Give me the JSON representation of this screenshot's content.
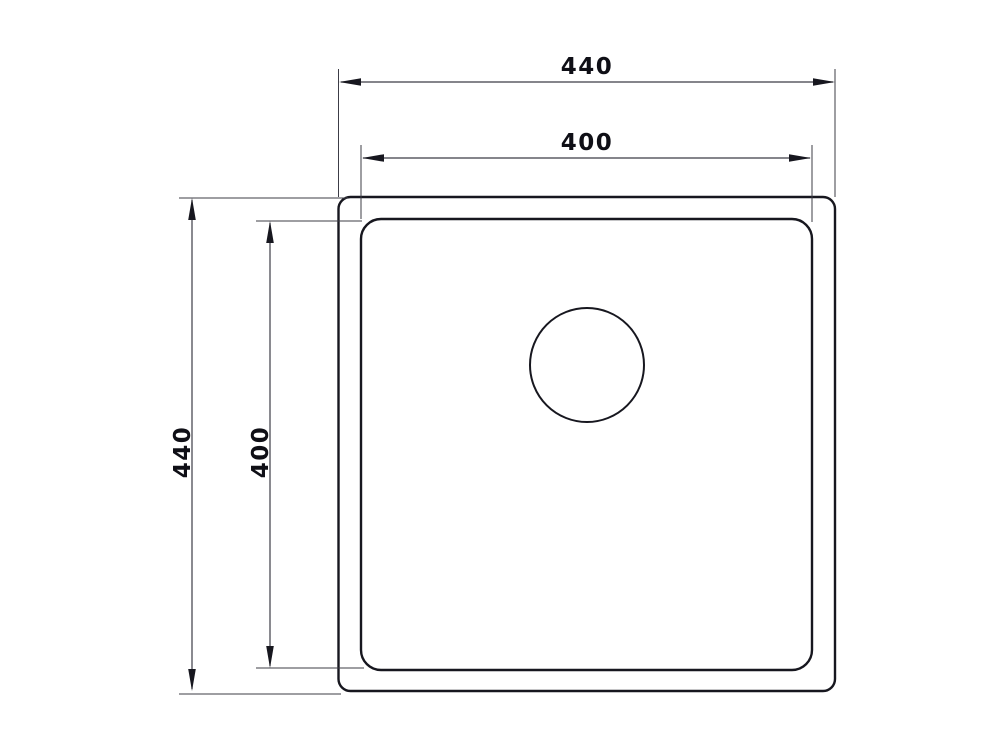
{
  "canvas": {
    "width": 1000,
    "height": 750,
    "background": "#ffffff"
  },
  "drawing": {
    "subject": "square-sink-top-view-with-drain",
    "colors": {
      "background": "#ffffff",
      "outline": "#17171f",
      "dimension": "#3c3c46",
      "text": "#0f0f16"
    },
    "dim_labels": {
      "top_outer": "440",
      "top_inner": "400",
      "left_outer": "440",
      "left_inner": "400"
    }
  }
}
